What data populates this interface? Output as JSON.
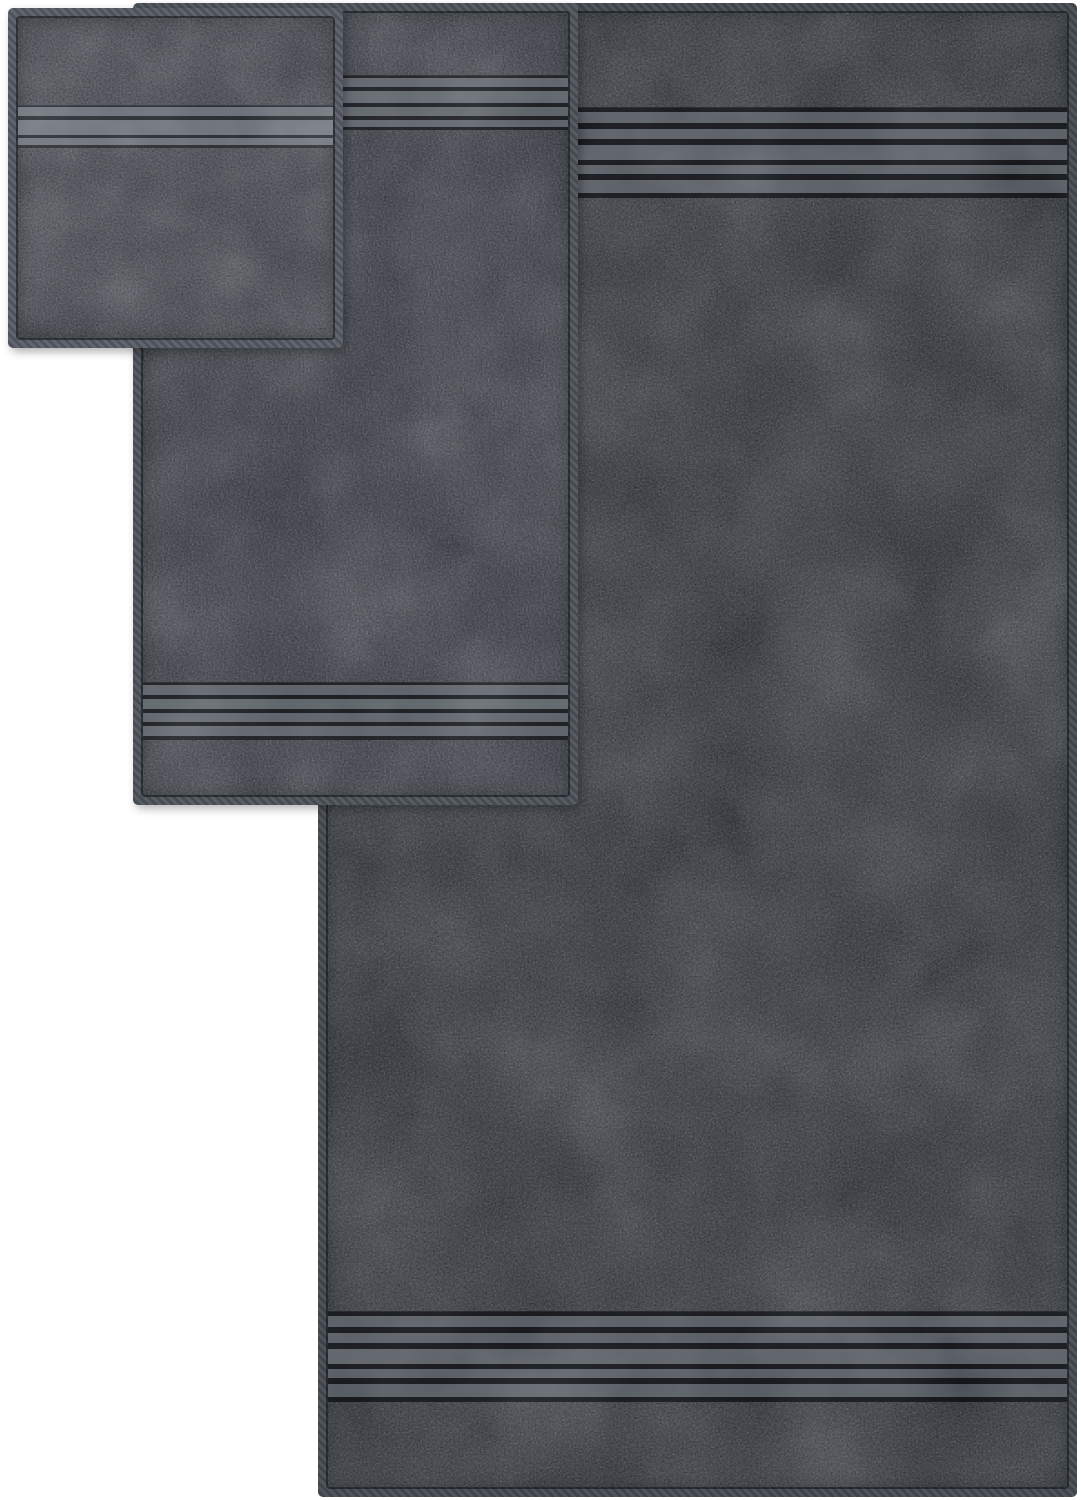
{
  "meta": {
    "title": "Charcoal gray three-piece towel set - product photo",
    "background_color": "#ffffff"
  },
  "scene": {
    "description": "Product photograph of three overlapping dark charcoal gray terry towels on a plain white background: a small washcloth in the top-left front layer, a medium hand towel in the middle layer, and a large bath towel behind on the right. Each towel has a sewn hem border and decorative smooth dobby bands of horizontal satin stripes near its edges.",
    "items": [
      {
        "id": "washcloth",
        "label": "Washcloth - small square towel, front layer, top left, single dobby stripe band in upper area",
        "fabric_color": "#42464c",
        "hem_color": "#5d626a",
        "band": {
          "stripe_color": "#6b7078",
          "line_color": "#2a2d31",
          "stripe_count": 3
        }
      },
      {
        "id": "hand-towel",
        "label": "Hand towel - medium towel, middle layer, dobby stripe bands near top and bottom edges",
        "fabric_color": "#3b3f45",
        "hem_color": "#53585f",
        "band": {
          "stripe_color": "#5e636a",
          "line_color": "#1e2024",
          "stripe_count": 4
        }
      },
      {
        "id": "bath-towel",
        "label": "Bath towel - large towel, back layer on the right, dobby stripe bands near top and bottom edges",
        "fabric_color": "#34383d",
        "hem_color": "#4d525a",
        "band": {
          "stripe_color": "#575c63",
          "line_color": "#17191d",
          "stripe_count": 5
        }
      }
    ]
  }
}
